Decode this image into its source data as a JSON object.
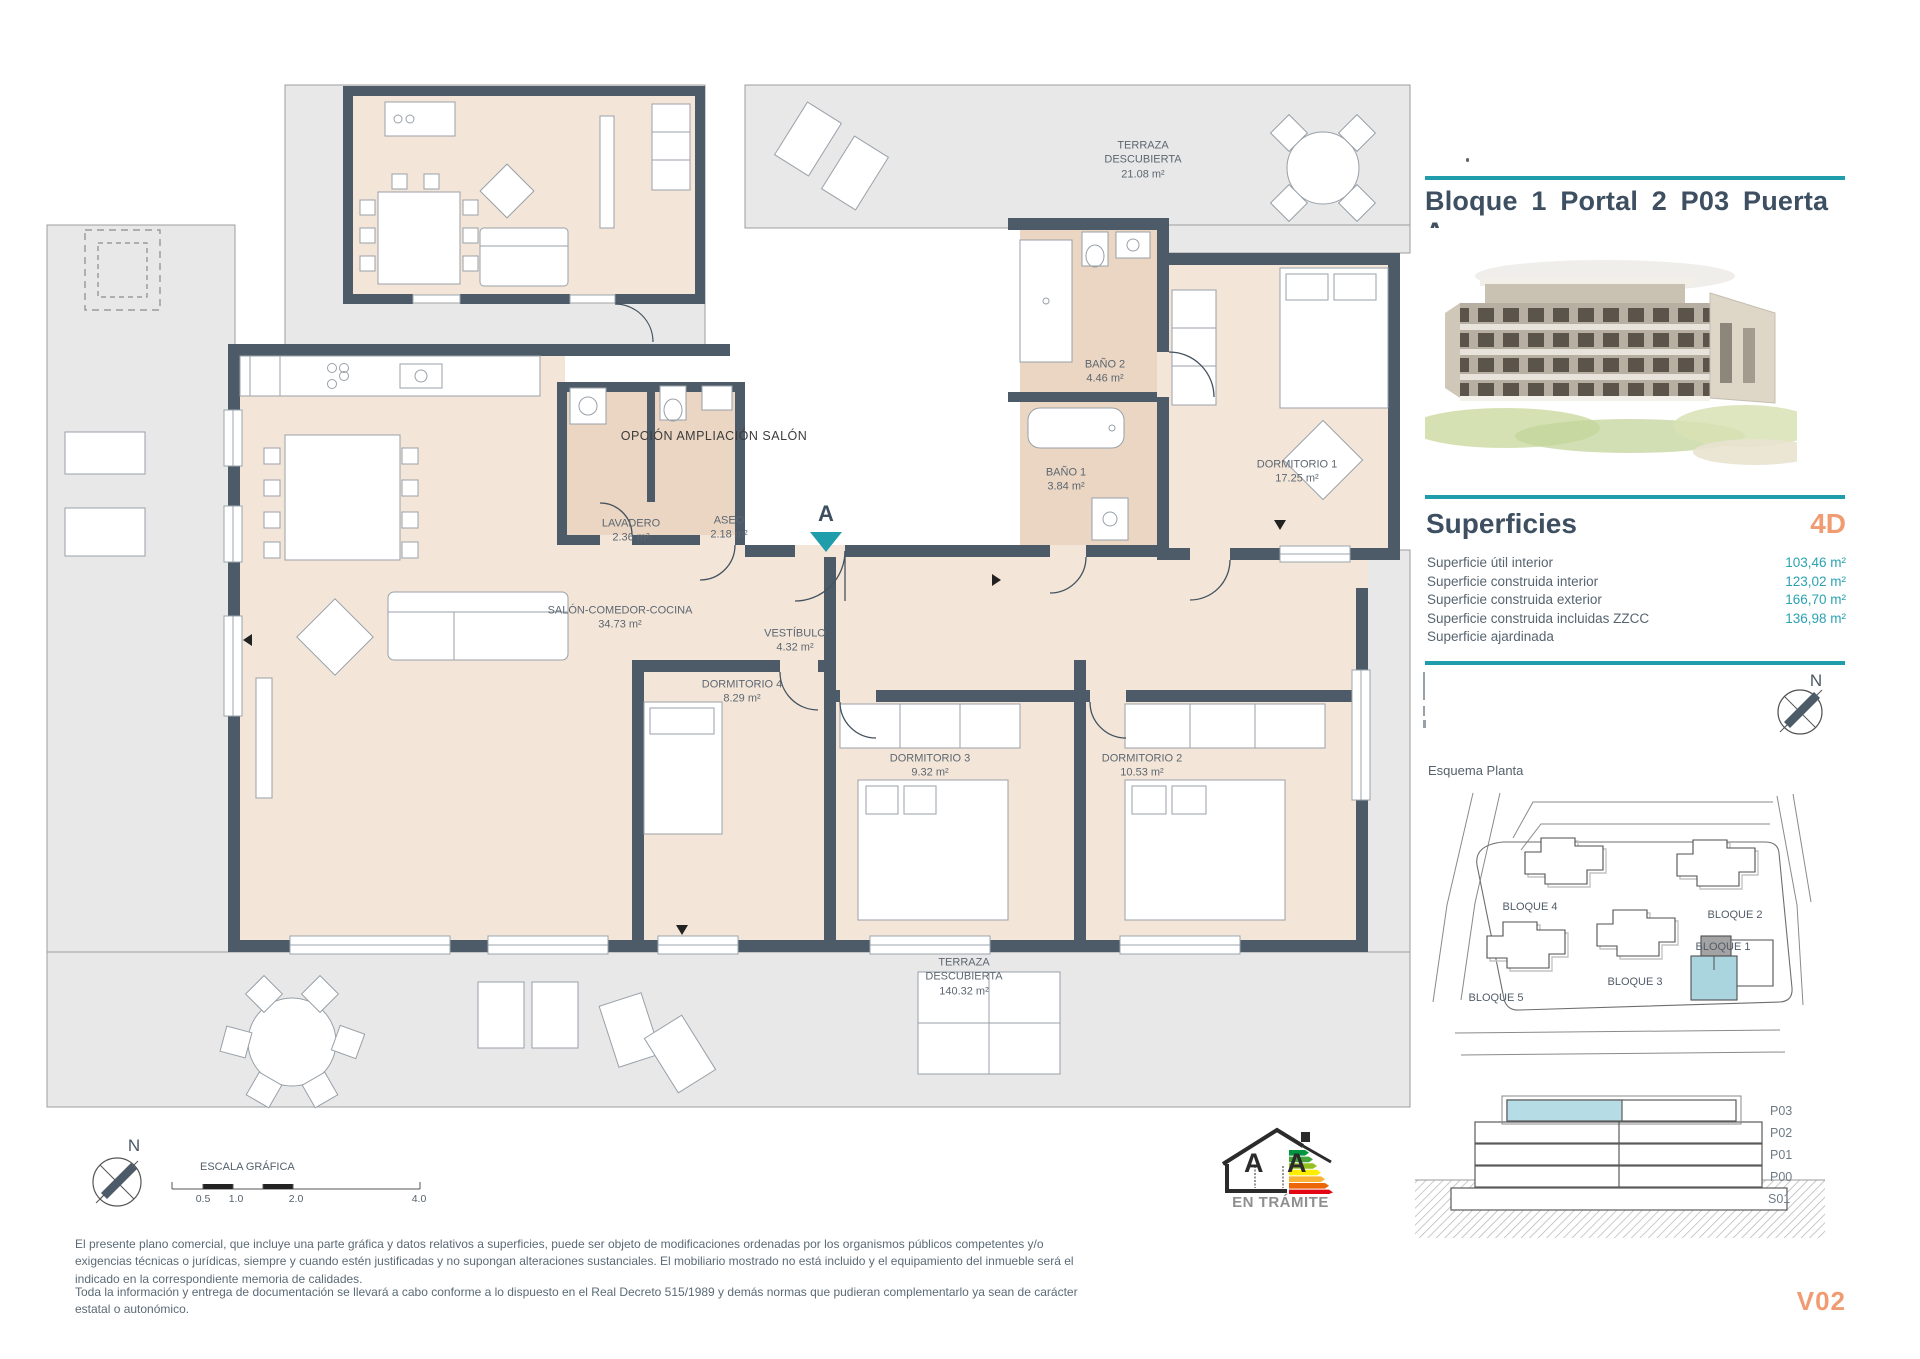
{
  "header": {
    "title": "Bloque 1  Portal 2  P03  Puerta A"
  },
  "panel": {
    "superficies_heading": "Superficies",
    "unit_type": "4D",
    "rows": [
      {
        "label": "Superficie útil interior",
        "value": "103,46 m²"
      },
      {
        "label": "Superficie construida interior",
        "value": "123,02 m²"
      },
      {
        "label": "Superficie construida exterior",
        "value": "166,70 m²"
      },
      {
        "label": "Superficie construida incluidas ZZCC",
        "value": "136,98 m²"
      },
      {
        "label": "Superficie ajardinada",
        "value": ""
      }
    ],
    "esquema_label": "Esquema Planta",
    "siteplan": {
      "b1": "BLOQUE 1",
      "b2": "BLOQUE 2",
      "b3": "BLOQUE 3",
      "b4": "BLOQUE 4",
      "b5": "BLOQUE 5"
    },
    "section": {
      "floors": [
        "P03",
        "P02",
        "P01",
        "P00",
        "S01"
      ],
      "highlighted": "P03"
    },
    "version": "V02",
    "compass_n": "N"
  },
  "plan": {
    "option_label": "OPCIÓN AMPLIACIÓN SALÓN",
    "section_marker": "A",
    "rooms": [
      {
        "name": "SALÓN-COMEDOR-COCINA",
        "area": "34.73 m²"
      },
      {
        "name": "LAVADERO",
        "area": "2.36 m²"
      },
      {
        "name": "ASEO",
        "area": "2.18 m²"
      },
      {
        "name": "VESTÍBULO",
        "area": "4.32 m²"
      },
      {
        "name": "DORMITORIO 4",
        "area": "8.29 m²"
      },
      {
        "name": "DORMITORIO 3",
        "area": "9.32 m²"
      },
      {
        "name": "DORMITORIO 2",
        "area": "10.53 m²"
      },
      {
        "name": "DORMITORIO 1",
        "area": "17.25 m²"
      },
      {
        "name": "BAÑO 1",
        "area": "3.84 m²"
      },
      {
        "name": "BAÑO 2",
        "area": "4.46 m²"
      }
    ],
    "terraza_top": {
      "name": "TERRAZA DESCUBIERTA",
      "area": "21.08 m²"
    },
    "terraza_bottom": {
      "name": "TERRAZA DESCUBIERTA",
      "area": "140.32 m²"
    }
  },
  "scalebar": {
    "label": "ESCALA GRÁFICA",
    "ticks": [
      "0.5",
      "1.0",
      "2.0",
      "4.0"
    ],
    "compass_n": "N"
  },
  "energy": {
    "letters": "A A",
    "status": "EN TRÁMITE"
  },
  "footer": {
    "para1": "El presente plano comercial, que incluye una parte gráfica y datos relativos a superficies, puede ser objeto de modificaciones ordenadas por los organismos públicos competentes y/o exigencias técnicas o jurídicas, siempre y cuando estén justificadas y no supongan alteraciones sustanciales. El mobiliario mostrado no está incluido y el equipamiento del inmueble será el indicado en la correspondiente memoria de calidades.",
    "para2": "Toda la información y entrega de documentación se llevará a cabo conforme a lo dispuesto en el Real Decreto 515/1989 y demás normas que pudieran complementarlo ya sean de carácter estatal o autonómico."
  },
  "colors": {
    "teal": "#1F9DAB",
    "accent_orange": "#F09B72",
    "wall": "#4D5B69"
  }
}
